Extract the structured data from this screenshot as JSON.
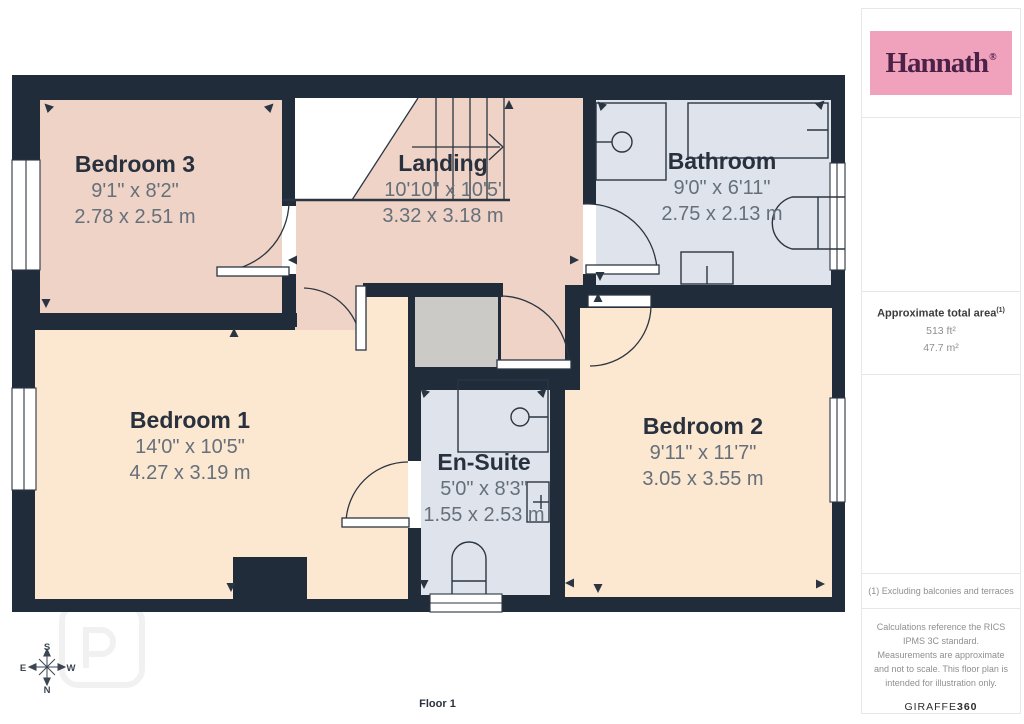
{
  "colors": {
    "wall": "#212c3a",
    "bedroom_floor": "#fce8d1",
    "pink_floor": "#eed3c6",
    "wet_floor": "#dfe4ec",
    "closet_floor": "#cbcac7",
    "line": "#2b3541",
    "brand_bg": "#f0a2bc",
    "brand_fg": "#4b2148",
    "title_text": "#28313d",
    "dim_text": "#65707b",
    "muted_text": "#8f8f8f",
    "border": "#e7e7e7"
  },
  "brand": {
    "name": "Hannath",
    "registered": "®"
  },
  "rooms": [
    {
      "id": "bedroom-3",
      "name": "Bedroom 3",
      "imperial": "9'1\" x 8'2\"",
      "metric": "2.78 x 2.51 m"
    },
    {
      "id": "landing",
      "name": "Landing",
      "imperial": "10'10\" x 10'5'",
      "metric": "3.32 x 3.18 m"
    },
    {
      "id": "bathroom",
      "name": "Bathroom",
      "imperial": "9'0\" x 6'11\"",
      "metric": "2.75 x 2.13 m"
    },
    {
      "id": "bedroom-1",
      "name": "Bedroom 1",
      "imperial": "14'0\" x 10'5\"",
      "metric": "4.27 x 3.19 m"
    },
    {
      "id": "en-suite",
      "name": "En-Suite",
      "imperial": "5'0\" x 8'3\"",
      "metric": "1.55 x 2.53 m"
    },
    {
      "id": "bedroom-2",
      "name": "Bedroom 2",
      "imperial": "9'11\" x 11'7\"",
      "metric": "3.05 x 3.55 m"
    }
  ],
  "sidebar": {
    "area_title": "Approximate total area",
    "area_sup": "(1)",
    "area_imperial": "513 ft²",
    "area_metric": "47.7 m²",
    "footnote": "(1) Excluding balconies and terraces",
    "disclaimer": "Calculations reference the RICS IPMS 3C standard. Measurements are approximate and not to scale. This floor plan is intended for illustration only.",
    "giraffe_regular": "GIRAFFE",
    "giraffe_bold": "360"
  },
  "footer": {
    "floor_label": "Floor 1"
  },
  "compass": {
    "top": "S",
    "left": "E",
    "right": "W",
    "bottom": "N"
  }
}
